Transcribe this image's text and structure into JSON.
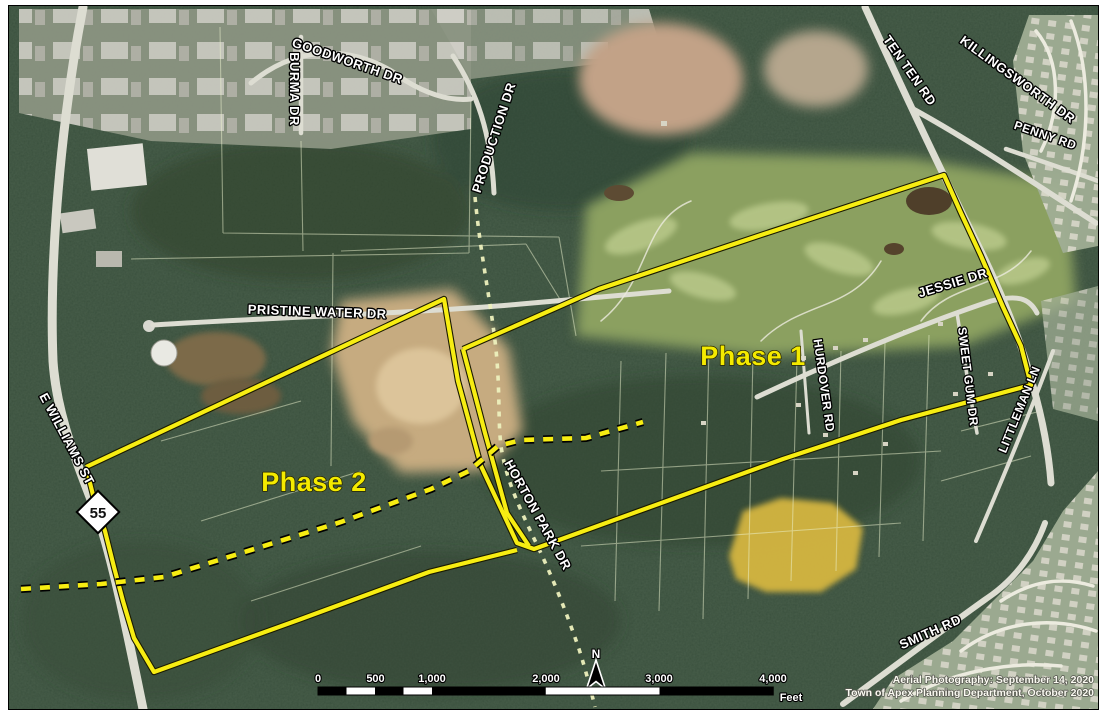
{
  "map": {
    "road_labels": [
      {
        "id": "goodworth-dr",
        "text": "GOODWORTH DR"
      },
      {
        "id": "burma-dr",
        "text": "BURMA DR"
      },
      {
        "id": "production-dr",
        "text": "PRODUCTION DR"
      },
      {
        "id": "ten-ten-rd",
        "text": "TEN TEN RD"
      },
      {
        "id": "killingsworth-dr",
        "text": "KILLINGSWORTH DR"
      },
      {
        "id": "penny-rd",
        "text": "PENNY RD"
      },
      {
        "id": "pristine-water-dr",
        "text": "PRISTINE WATER DR"
      },
      {
        "id": "jessie-dr",
        "text": "JESSIE DR"
      },
      {
        "id": "hurdover-rd",
        "text": "HURDOVER RD"
      },
      {
        "id": "sweet-gum-dr",
        "text": "SWEET GUM DR"
      },
      {
        "id": "littleman-ln",
        "text": "LITTLEMAN LN"
      },
      {
        "id": "e-williams-st",
        "text": "E WILLIAMS ST"
      },
      {
        "id": "horton-park-dr",
        "text": "HORTON PARK DR"
      },
      {
        "id": "smith-rd",
        "text": "SMITH RD"
      }
    ],
    "phase_labels": [
      {
        "id": "phase-1",
        "text": "Phase 1"
      },
      {
        "id": "phase-2",
        "text": "Phase 2"
      }
    ],
    "route_shield": {
      "number": "55"
    },
    "north_arrow": {
      "label": "N"
    },
    "scale_bar": {
      "tick_labels": [
        "0",
        "500",
        "1,000",
        "2,000",
        "3,000",
        "4,000"
      ],
      "unit_label": "Feet"
    },
    "attribution": {
      "line1": "Aerial Photography: September 14, 2020",
      "line2": "Town of Apex Planning Department, October 2020"
    },
    "colors": {
      "boundary_yellow": "#f7ed12",
      "phase_label_yellow": "#f4ea00",
      "pale_dash": "#edf0bd"
    }
  }
}
